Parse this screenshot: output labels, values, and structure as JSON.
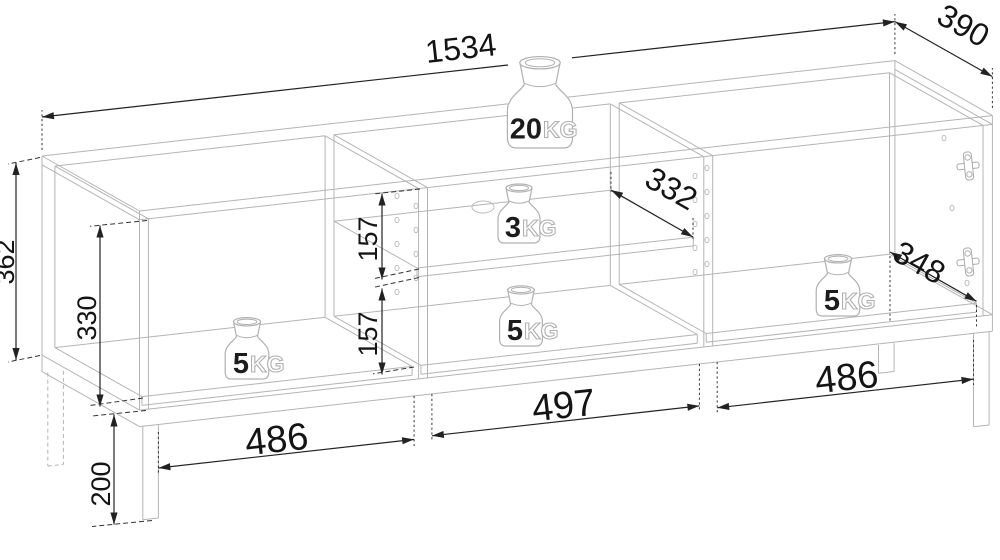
{
  "drawing": {
    "title": "Furniture technical drawing with dimensions",
    "units": "mm",
    "colors": {
      "background": "#ffffff",
      "furniture_line": "#b4b4b4",
      "dimension_line": "#222222",
      "text": "#141414",
      "kg_outline_text": "#b0b0b0"
    },
    "model_mm": {
      "overall_width": 1534,
      "overall_depth": 390,
      "carcass_height": 362,
      "leg_height": 200,
      "panel_thickness": 16,
      "compartment_widths": {
        "left": 486,
        "middle": 497,
        "right": 486
      },
      "left_opening_height": 330,
      "shelf_spacing_upper": 157,
      "shelf_spacing_lower": 157,
      "shelf_depth": 332,
      "interior_floor_depth": 348
    },
    "dimensions": {
      "overall_width": "1534",
      "overall_depth": "390",
      "overall_height": "362",
      "left_opening_height": "330",
      "shelf_gap_upper": "157",
      "shelf_gap_lower": "157",
      "shelf_depth": "332",
      "floor_depth": "348",
      "leg_height": "200",
      "bottom_left_width": "486",
      "bottom_middle_width": "497",
      "bottom_right_width": "486"
    },
    "load_capacities": [
      {
        "id": "top",
        "num": "20",
        "unit": "KG",
        "location": "top panel"
      },
      {
        "id": "middle-shelf",
        "num": "3",
        "unit": "KG",
        "location": "middle shelf"
      },
      {
        "id": "middle-bottom",
        "num": "5",
        "unit": "KG",
        "location": "middle compartment floor"
      },
      {
        "id": "left-compartment",
        "num": "5",
        "unit": "KG",
        "location": "left compartment floor"
      },
      {
        "id": "right-compartment",
        "num": "5",
        "unit": "KG",
        "location": "right compartment floor"
      }
    ]
  }
}
